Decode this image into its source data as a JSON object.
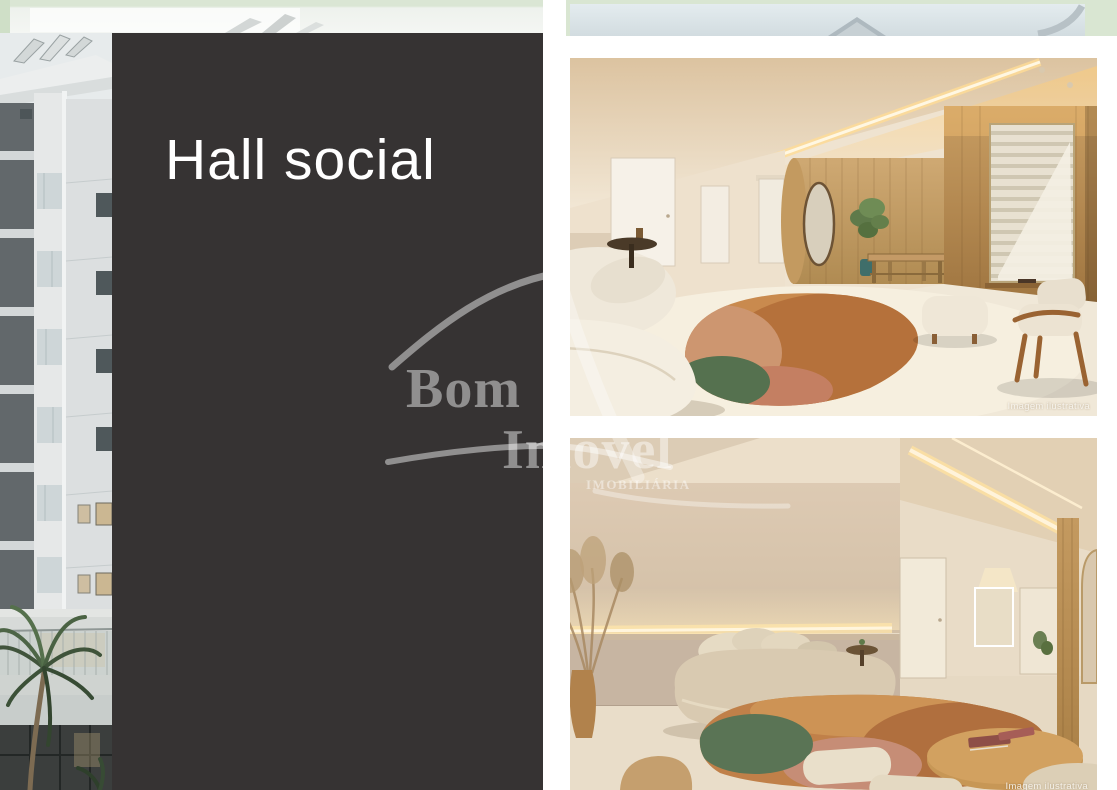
{
  "page": {
    "title": "Hall social",
    "background": "#ffffff"
  },
  "panel": {
    "title": "Hall social",
    "color": "#363333",
    "text_color": "#ffffff"
  },
  "watermark": {
    "brand_line1": "Bom",
    "brand_line2": "Imóvel",
    "brand_line3": "IMOBILIÁRIA",
    "color": "rgba(255,255,255,0.45)"
  },
  "gallery": {
    "images": [
      {
        "name": "social-hall-lobby-render",
        "caption": "Imagem ilustrativa"
      },
      {
        "name": "social-hall-lounge-render",
        "caption": "Imagem ilustrativa"
      }
    ]
  },
  "palette": {
    "top_strip_green": "#d9e6d2",
    "top_strip_blue": "#dbe4e8",
    "panel_dark": "#363333",
    "wood": "#c29a5e",
    "floor_cream": "#efe6d5",
    "rug_orange": "#c07a44",
    "rug_rust": "#b06f3e",
    "rug_green": "#567055",
    "rug_pink": "#c68d76"
  }
}
